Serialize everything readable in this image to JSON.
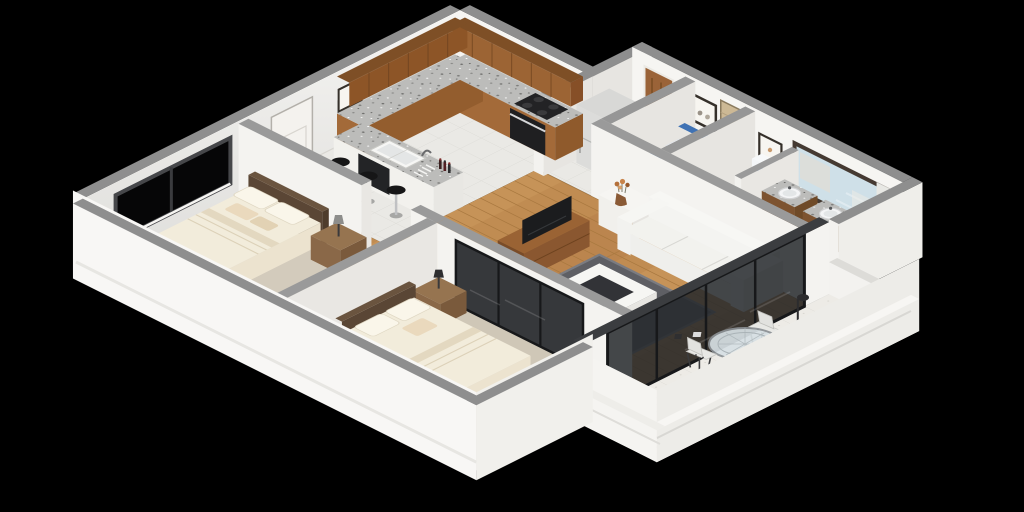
{
  "scene": {
    "title": "3D isometric cutaway floor plan render of an apartment",
    "background": "#000000",
    "view": "isometric top-down cutaway, black backdrop, no visible text"
  },
  "palette": {
    "wall_top": "#8e8e8e",
    "wall_face": "#f4f3f0",
    "wall_face_shaded": "#e7e5e1",
    "exterior_face": "#f8f7f5",
    "floor_tile": "#eae9e5",
    "floor_wood": "#c08c52",
    "carpet_bedroom1": "#d3cbbc",
    "carpet_bedroom2": "#cfc7b7",
    "balcony_tile": "#edebe6",
    "cabinet_wood": "#9c6434",
    "granite_counter": "#bcbcba",
    "appliance_black": "#232325",
    "fridge_steel": "#dcdcda",
    "bedding_cream": "#f2ecdb",
    "bed_frame_wood": "#5a4635",
    "nursery_blue": "#4f82c4",
    "sofa_white": "#f2f2ee",
    "rug_gray": "#5e5f64",
    "mirror_glass": "#cfe0e8",
    "towel_blue": "#3e6fae",
    "glass_dark": "#25282b",
    "window_glass": "#060607"
  },
  "rooms": [
    {
      "id": "kitchen",
      "name": "Kitchen",
      "floor": "white tile"
    },
    {
      "id": "entry-hall",
      "name": "Entry hall",
      "floor": "white tile"
    },
    {
      "id": "hallway",
      "name": "Hallway wing",
      "floor": "white tile"
    },
    {
      "id": "nursery",
      "name": "Small bedroom / nursery",
      "floor": "white tile"
    },
    {
      "id": "bathroom",
      "name": "Bathroom",
      "floor": "white tile"
    },
    {
      "id": "living-room",
      "name": "Living room",
      "floor": "wood planks"
    },
    {
      "id": "bedroom-1",
      "name": "Master bedroom",
      "floor": "beige carpet"
    },
    {
      "id": "bedroom-2",
      "name": "Second bedroom",
      "floor": "beige carpet"
    },
    {
      "id": "balcony",
      "name": "Balcony terrace",
      "floor": "light tile"
    }
  ],
  "furniture": {
    "kitchen": [
      "wood upper cabinets",
      "wood base cabinets",
      "granite countertops",
      "black stove and oven",
      "refrigerator",
      "peninsula bar with sink",
      "three black bar stools",
      "wine bottles",
      "dish rack"
    ],
    "entry_hall": [
      "white entry door",
      "small picture frame"
    ],
    "hallway": [
      "wooden door",
      "framed picture"
    ],
    "nursery": [
      "single bed with blue bedding"
    ],
    "bathroom": [
      "toilet with blue lid",
      "two wood vanities with round basins",
      "large framed mirror",
      "blue polka-dot towel",
      "tiled shower corner",
      "window blinds",
      "framed picture",
      "small cabinet"
    ],
    "living_room": [
      "white three-seat sofa",
      "white console with flower vase",
      "wood sideboard with TV",
      "dark gray rug",
      "white square coffee table",
      "dark framed glass partition",
      "glass sliding doors to balcony"
    ],
    "bedroom_1": [
      "double bed with cream bedding",
      "dark wood headboard",
      "nightstand with lamp",
      "large black-framed window"
    ],
    "bedroom_2": [
      "double bed with cream bedding",
      "two nightstands",
      "dark lamp"
    ],
    "balcony": [
      "round glass dining table",
      "four patterned chairs",
      "white lounge chair",
      "dark floor lamp",
      "white parapet railing"
    ]
  }
}
